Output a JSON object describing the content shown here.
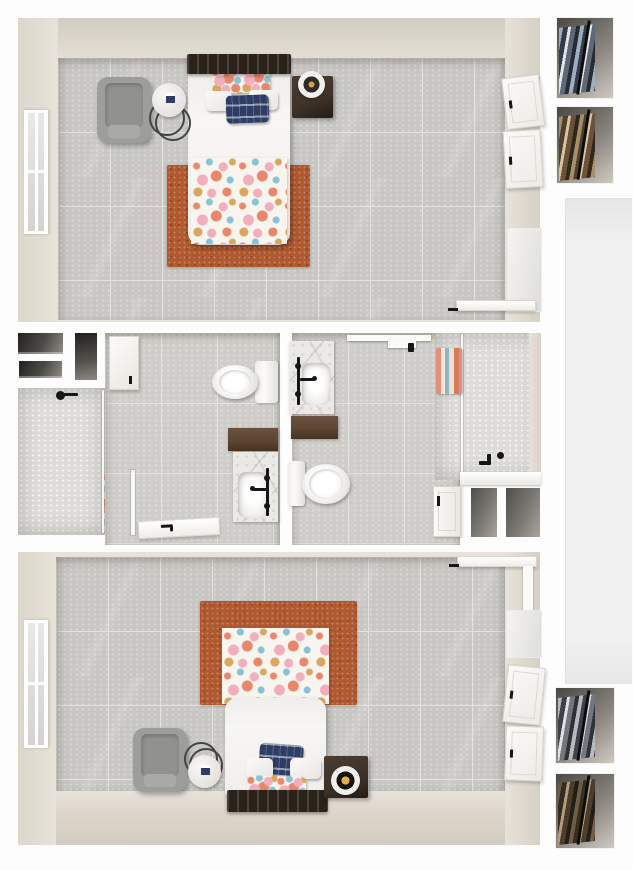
{
  "scene": {
    "type": "3d-floorplan",
    "view": "top-down",
    "description": "Photorealistic top-down 3D render of a floor plan with two bedrooms, two bathrooms and wardrobe closets"
  },
  "labels": {
    "plan": "3D floor plan - two bedrooms and two bathrooms, top-down view",
    "bedroom_top": "Bedroom (top)",
    "bedroom_bottom": "Bedroom (bottom)",
    "bathroom_left": "Bathroom (left)",
    "bathroom_right": "Bathroom (right)",
    "bed": "Bed with floral duvet",
    "rug": "Rust area rug",
    "armchair": "Gray armchair",
    "side_table": "Round marble side table",
    "nightstand": "Dark wood nightstand",
    "window": "Window",
    "closet_door": "Closet door",
    "open_door": "Open door",
    "mirror": "Leaning mirror panel",
    "shower": "Walk-in shower with glass door",
    "tub_shower": "Tub shower with glass panel",
    "toilet": "Toilet",
    "vanity": "Vanity with marble sink and black faucet",
    "wall_cabinet": "Wall cabinet",
    "linen_niche": "Linen shelf niche",
    "storage_niche": "Storage niche",
    "towels": "Towels",
    "wardrobe": "Closet with hanging clothes",
    "hallway": "Hallway strip"
  },
  "palette": {
    "background": "#fdfdfd",
    "wall_face": "#e7e3da",
    "wall_face_dark": "#d2ccc1",
    "tile_floor": "#c8c7c4",
    "tile_floor_bath": "#cecdc9",
    "grout": "#e3e2de",
    "rug": "#b0582e",
    "bedding_white": "#f7f6f4",
    "headboard_wood": "#2b221a",
    "nightstand_wood": "#3e3228",
    "vanity_wood": "#5d4634",
    "armchair_gray": "#9d9d9b",
    "navy_pillow": "#2e3d66",
    "floral_coral": "#e8876b",
    "floral_pink": "#f1aebc",
    "floral_teal": "#85c3d6",
    "floral_gold": "#d9a75f",
    "porcelain": "#f4f3f1",
    "marble": "#ebe9e5",
    "shower_tile": "#dedcd8",
    "fixture_black": "#161616",
    "niche_dark": "#2a2927",
    "hall_strip": "#f0f0f1"
  },
  "rooms": [
    {
      "id": "bedroom-top",
      "label": "Bedroom (top)",
      "furniture": [
        "bed with floral duvet",
        "floral accent pillow",
        "two white pillows",
        "navy patterned pillow",
        "rust area rug",
        "gray armchair",
        "round marble side table",
        "dark wood nightstand with round tray",
        "window",
        "two closet doors",
        "open entry door",
        "mirror panel"
      ]
    },
    {
      "id": "bathroom-left",
      "label": "Bathroom (left)",
      "furniture": [
        "walk-in shower with glass door",
        "black shower head",
        "rolled towels",
        "toilet",
        "dark wood counter",
        "marble sink with black cross-handle faucet",
        "white wall cabinet",
        "linen niches",
        "open door"
      ]
    },
    {
      "id": "bathroom-right",
      "label": "Bathroom (right)",
      "furniture": [
        "marble sink with black cross-handle faucet",
        "dark wood cabinet",
        "toilet",
        "tub shower with glass panel",
        "hanging printed towel",
        "black tub fixtures",
        "wall shelf",
        "towel hook",
        "two storage niches",
        "open door"
      ]
    },
    {
      "id": "bedroom-bottom",
      "label": "Bedroom (bottom)",
      "furniture": [
        "bed with floral duvet",
        "floral accent pillow",
        "two white pillows",
        "navy patterned pillow",
        "rust area rug",
        "gray armchair",
        "round marble side table",
        "dark wood nightstand with round decor",
        "window",
        "two closet doors",
        "open entry door",
        "mirror panel"
      ]
    },
    {
      "id": "closet-column",
      "label": "Wardrobe closets",
      "furniture": [
        "closet with blue-gray hanging clothes",
        "closet with brown hanging clothes",
        "hallway strip",
        "closet with gray hanging clothes",
        "closet with dark brown hanging clothes"
      ]
    }
  ]
}
